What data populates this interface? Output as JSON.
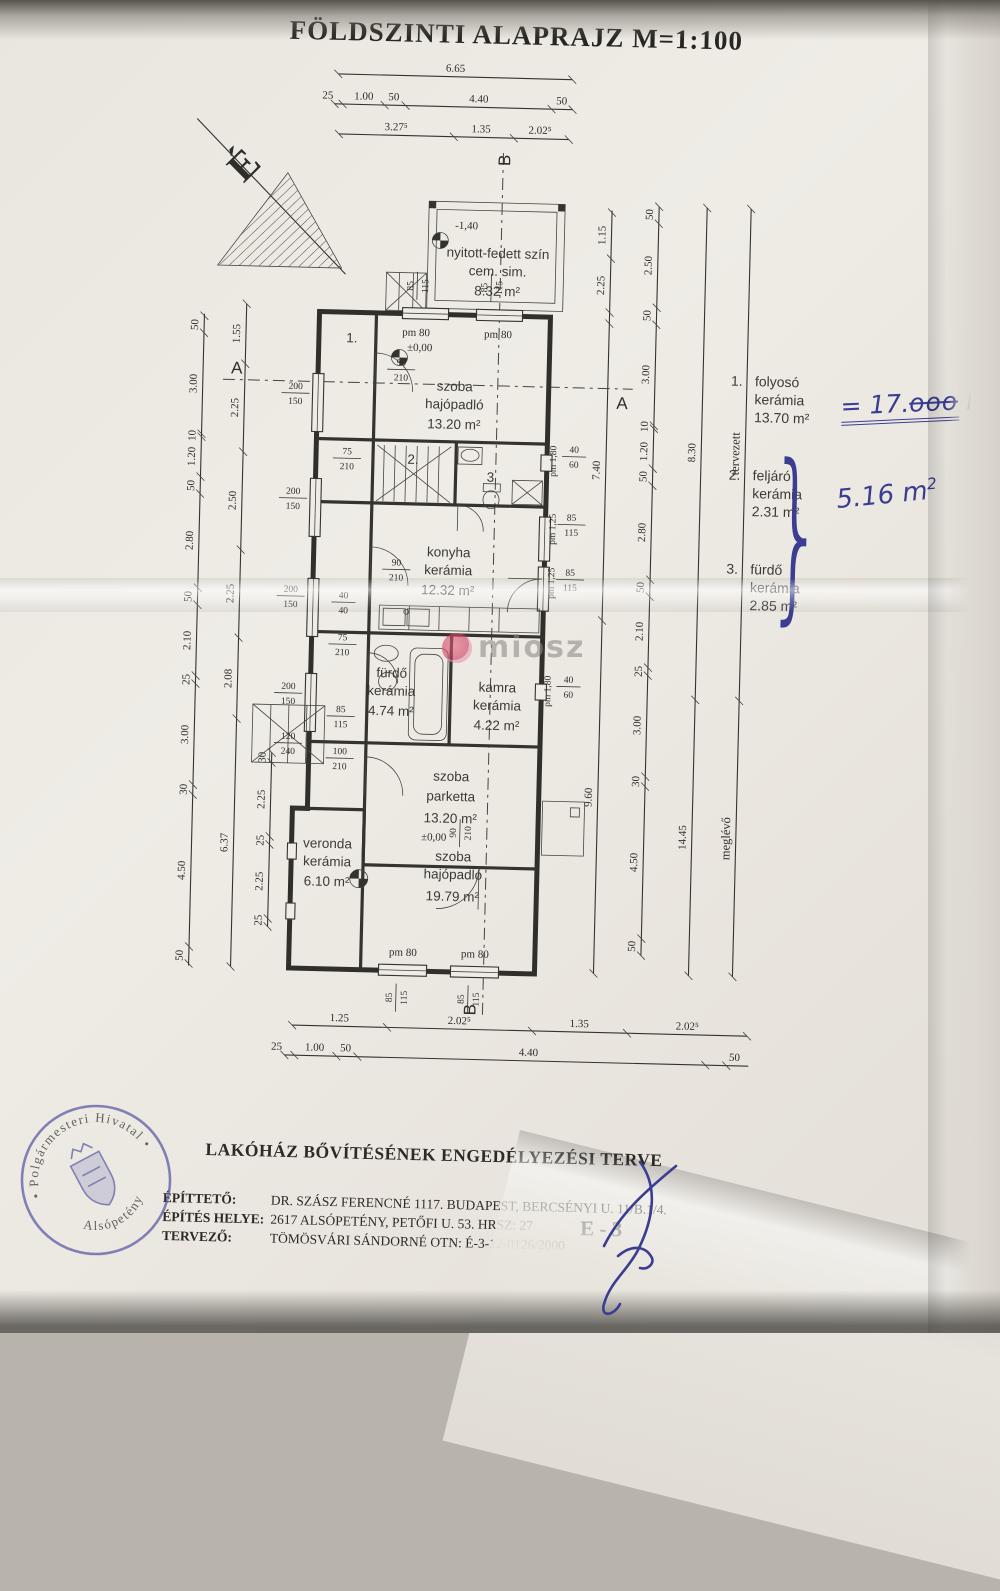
{
  "page": {
    "title": "FÖLDSZINTI ALAPRAJZ M=1:100",
    "north_letter": "É"
  },
  "watermark": {
    "text": "miosz"
  },
  "plan": {
    "shed": {
      "l1": "nyitott-fedett szín",
      "l2": "cem. sim.",
      "l3": "8.32 m²",
      "level": "-1,40"
    },
    "rooms": {
      "szoba1": {
        "l1": "szoba",
        "l2": "hajópadló",
        "l3": "13.20 m²"
      },
      "konyha": {
        "l1": "konyha",
        "l2": "kerámia",
        "l3": "12.32 m²"
      },
      "furdo": {
        "l1": "fürdő",
        "l2": "kerámia",
        "l3": "4.74 m²"
      },
      "kamra": {
        "l1": "kamra",
        "l2": "kerámia",
        "l3": "4.22 m²"
      },
      "parketta": {
        "l1": "szoba",
        "l2": "parketta",
        "l3": "13.20 m²"
      },
      "veranda": {
        "l1": "veronda",
        "l2": "kerámia",
        "l3": "6.10 m²"
      },
      "szoba2": {
        "l1": "szoba",
        "l2": "hajópadló",
        "l3": "19.79 m²"
      }
    },
    "marks": {
      "pm80": "pm 80",
      "pm125": "pm 1,25",
      "pm180": "pm 1,80",
      "zero": "±0,00",
      "minus": "-1,40",
      "secA": "A",
      "secB": "B",
      "n1": "1.",
      "n2": "2.",
      "n3": "3"
    },
    "fractions": {
      "f200_150": {
        "a": "200",
        "b": "150"
      },
      "f85_115": {
        "a": "85",
        "b": "115"
      },
      "f90_210": {
        "a": "90",
        "b": "210"
      },
      "f75_210": {
        "a": "75",
        "b": "210"
      },
      "f100_210": {
        "a": "100",
        "b": "210"
      },
      "f120_240": {
        "a": "120",
        "b": "240"
      },
      "f40_60": {
        "a": "40",
        "b": "60"
      },
      "f40_40": {
        "a": "40",
        "b": "40"
      }
    }
  },
  "dims": {
    "top_total": "6.65",
    "top_row": [
      "25",
      "1.00",
      "50",
      "4.40",
      "50"
    ],
    "top_axes": [
      "3.27⁵",
      "1.35",
      "2.02⁵"
    ],
    "bottom_axes": [
      "1.25",
      "2.02⁵",
      "1.35",
      "2.02⁵"
    ],
    "bottom_row": [
      "25",
      "1.00",
      "50",
      "4.40",
      "50"
    ],
    "left_outer": [
      "50",
      "3.00",
      "10",
      "1.20",
      "50",
      "2.80",
      "50",
      "2.10",
      "25",
      "3.00",
      "30",
      "4.50",
      "50"
    ],
    "left_inner": [
      "1.55",
      "2.25",
      "2.50",
      "2.25",
      "2.08",
      "6.37"
    ],
    "left_steps": [
      "30",
      "2.25",
      "25",
      "2.25",
      "25"
    ],
    "right_top": [
      "1.15",
      "2.25"
    ],
    "right_detail": [
      "50",
      "2.50",
      "50",
      "3.00",
      "10",
      "1.20",
      "50",
      "2.80",
      "50",
      "2.10",
      "25",
      "3.00",
      "30",
      "4.50",
      "50"
    ],
    "right_inner": {
      "upper": "7.40",
      "lower": "9.60"
    },
    "right_totals": {
      "upper": "8.30",
      "lower": "14.45"
    },
    "right_words": {
      "upper": "tervezett",
      "lower": "meglévő"
    }
  },
  "legend": {
    "items": [
      {
        "no": "1.",
        "name": "folyosó",
        "material": "kerámia",
        "area": "13.70 m²"
      },
      {
        "no": "2.",
        "name": "feljáró",
        "material": "kerámia",
        "area": "2.31 m²"
      },
      {
        "no": "3.",
        "name": "fürdő",
        "material": "kerámia",
        "area": "2.85 m²"
      }
    ]
  },
  "notes": {
    "eq": "= 17.",
    "crossed": "ooo",
    "unit": " m",
    "sup": "2",
    "sum": "5.16 m",
    "ink": "#3a3d92"
  },
  "title_block": {
    "project": "LAKÓHÁZ BŐVÍTÉSÉNEK ENGEDÉLYEZÉSI TERVE",
    "rows": [
      {
        "label": "ÉPÍTTETŐ:",
        "value": "DR. SZÁSZ FERENCNÉ 1117. BUDAPEST, BERCSÉNYI U. 11/B.1/4."
      },
      {
        "label": "ÉPÍTÉS HELYE:",
        "value": "2617 ALSÓPETÉNY, PETŐFI U. 53. HRSZ: 27"
      },
      {
        "label": "TERVEZŐ:",
        "value": "TÖMÖSVÁRI SÁNDORNÉ  OTN: É-3-12-0126/2000"
      }
    ],
    "sheet": "E - 3"
  },
  "stamp": {
    "arc_top": "• Polgármesteri Hivatal •",
    "arc_bottom": "Alsópetény",
    "color": "#4c4f9f"
  }
}
